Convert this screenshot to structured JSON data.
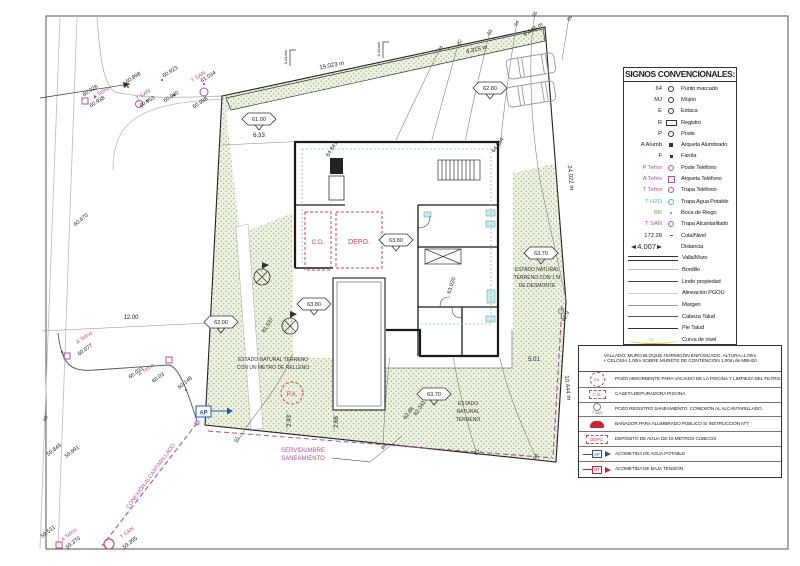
{
  "legend": {
    "title": "SIGNOS CONVENCIONALES:",
    "curva_value": "53",
    "items": [
      {
        "key": "64",
        "desc": "Punto marcado"
      },
      {
        "key": "MJ",
        "desc": "Mojón"
      },
      {
        "key": "E",
        "desc": "Estaca"
      },
      {
        "key": "R",
        "desc": "Registro"
      },
      {
        "key": "P",
        "desc": "Poste"
      },
      {
        "key": "A Alumb",
        "desc": "Arqueta Alumbrado"
      },
      {
        "key": "F",
        "desc": "Farola"
      },
      {
        "key": "P Tefno",
        "desc": "Poste Teléfono"
      },
      {
        "key": "A Tefno",
        "desc": "Arqueta Teléfono"
      },
      {
        "key": "T Tefno",
        "desc": "Trapa Teléfono"
      },
      {
        "key": "T H2O",
        "desc": "Trapa Agua Potable"
      },
      {
        "key": "BR",
        "desc": "Boca de Riego"
      },
      {
        "key": "T SAN",
        "desc": "Trapa Alcantarillado"
      },
      {
        "key": "172.28",
        "desc": "Cota/Nivel"
      },
      {
        "key": "4.007",
        "desc": "Distancia"
      }
    ],
    "line_items": [
      {
        "desc": "Valla/Muro"
      },
      {
        "desc": "Bordillo"
      },
      {
        "desc": "Linde propiedad"
      },
      {
        "desc": "Alineación PGOU"
      },
      {
        "desc": "Margen"
      },
      {
        "desc": "Cabeza Talud"
      },
      {
        "desc": "Pie Talud"
      },
      {
        "desc": "Curva de nivel"
      }
    ]
  },
  "notes": {
    "header1": "VALLADO: MURO BLOQUE HORMIGÓN ENFOSCADO. ALTURA=1.00m",
    "header2": "+ CELOSÍA 1.00m SOBRE MURETE DE CONTENCIÓN 1.00m de MBH20",
    "rows": [
      {
        "sym": "P.A.",
        "desc": "POZO ABSORBENTE PARA VACIADO DE LA PISCINA Y LIMPIEZA DEL FILTRO"
      },
      {
        "sym": "C.D.",
        "desc": "CASETA DEPURADORA PISCINA"
      },
      {
        "sym": "T SAN",
        "desc": "POZO REGISTRO SANEAMIENTO. CONEXIÓN AL ALCANTARILLADO"
      },
      {
        "sym": "",
        "desc": "BAÑADOR PARA ALUMBRADO PÚBLICO S/ INSTRUCCIÓN Nº7"
      },
      {
        "sym": "DEPO.",
        "desc": "DEPÓSITO DE AGUA DE 15 METROS CÚBICOS"
      },
      {
        "sym": "AP",
        "desc": "ACOMETIDA DE AGUA POTABLE"
      },
      {
        "sym": "BT",
        "desc": "ACOMETIDA DE BAJA TENSIÓN"
      }
    ]
  },
  "plan": {
    "dims": {
      "top": "19.023 m",
      "right_upper": "24.022 m",
      "right_lower": "10.444 m",
      "ne1": "4.315 m",
      "ne2": "4.445 m",
      "road": "12.00",
      "entry": "6.33",
      "se": "5.01",
      "pool1": "2.43",
      "pool2": "2.66"
    },
    "cotas": {
      "c1": "61.00",
      "c2": "62.00",
      "c3": "62.80",
      "c4": "63.80",
      "c5": "63.80",
      "c6": "63.70",
      "c7": "63.70"
    },
    "points": {
      "p1": "60.928",
      "p2": "60.898",
      "p3": "60.923",
      "p4": "60.938",
      "p5": "60.953",
      "p6": "60.980",
      "p7": "61.034",
      "p8": "60.998",
      "p9": "60.670",
      "p10": "60.077",
      "p11": "60.031",
      "p12": "60.03",
      "p13": "60.148",
      "p14": "59.849",
      "p15": "59.691",
      "p16": "59.531",
      "p17": "59.370",
      "p18": "59.395",
      "p19": "64.841",
      "p20": "64.064",
      "p21": "63.020",
      "p22": "61.537",
      "p23": "62.241",
      "p24": "62.86",
      "p25": "62.9"
    },
    "contours": {
      "k60": "60",
      "k61": "61",
      "k62": "62",
      "k63": "63",
      "k64": "64",
      "k65": "65",
      "k66": "66"
    },
    "utilities": {
      "a_tefno": "A Tefno",
      "t_san": "T SAN",
      "a_alumb": "A Alumb",
      "ap": "AP"
    },
    "annotations": {
      "desmonte1": "ESTADO NATURAL",
      "desmonte2": "TERRENO CON 1 M",
      "desmonte3": "DE DESMONTE",
      "relleno1": "ESTADO NATURAL TERRENO",
      "relleno2": "CON UN METRO DE RELLENO",
      "natural1": "ESTADO",
      "natural2": "NATURAL",
      "natural3": "TERRENO",
      "serv1": "SERVIDUMBRE",
      "serv2": "SANEAMIENTO",
      "conexion": "CONEXIÓN ALCANTARILLADO",
      "cd": "C.D.",
      "depo": "DEPO.",
      "pa": "P.A."
    }
  }
}
